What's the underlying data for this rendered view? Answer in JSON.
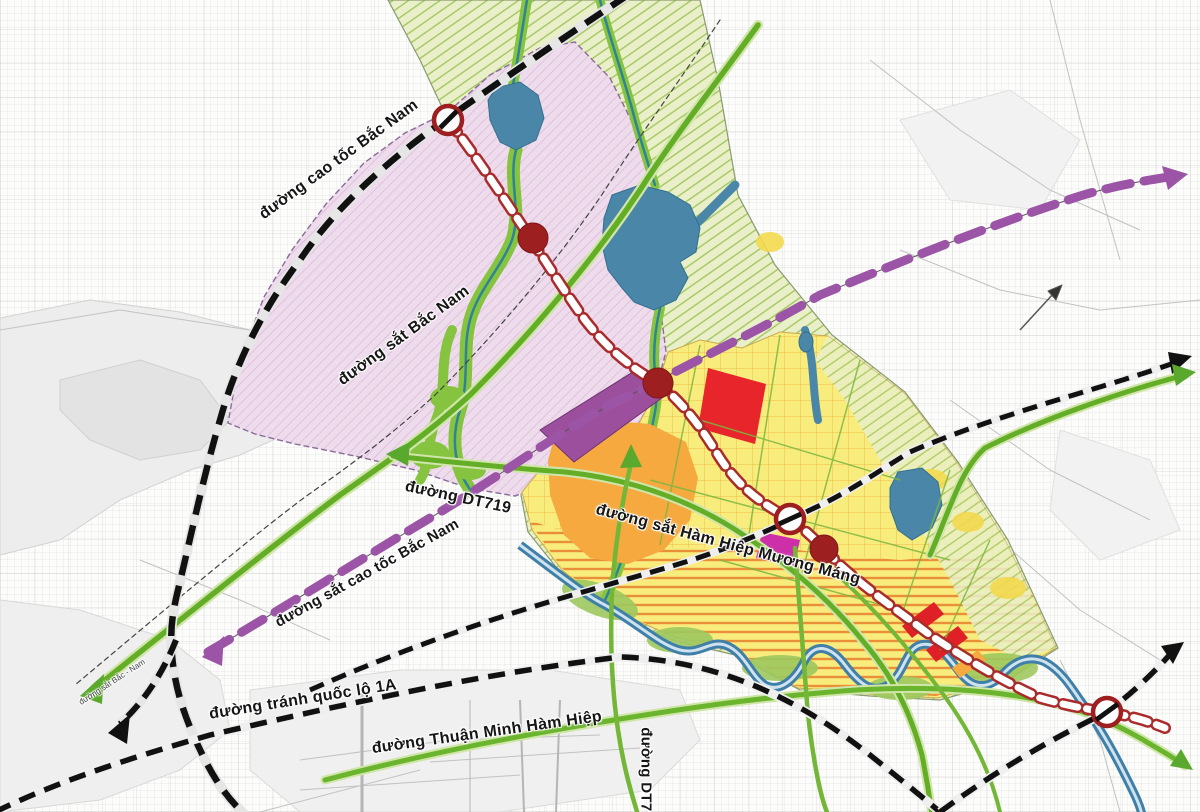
{
  "labels": {
    "expressway": "đường cao tốc Bắc Nam",
    "railway_north_south": "đường sắt Bắc Nam",
    "road_dt719": "đường DT719",
    "hsr": "đường sắt cao tốc Bắc Nam",
    "bypass_1a": "đường tránh quốc lộ 1A",
    "road_thuan_minh": "đường Thuận Minh Hàm Hiệp",
    "railway_ham_hiep": "đường sắt Hàm Hiệp Mương Máng",
    "road_dt718": "đường DT718",
    "railway_small": "đường sắt Bắc - Nam"
  },
  "colors": {
    "zone_pink": "#eedcec",
    "zone_green_hatch": "#e7efc6",
    "zone_green_stripe": "#a9c968",
    "zone_yellow": "#f8ec7d",
    "zone_orange": "#f5a93f",
    "zone_purple_block": "#9c4f9c",
    "zone_red_block": "#e8252a",
    "zone_magenta_block": "#cc2fa8",
    "water": "#4a86a8",
    "river_green_buffer": "#86c440",
    "road_green": "#63ad27",
    "road_black_dashed": "#111111",
    "hsr_purple": "#9c55a6",
    "railway_oval_red": "#aa2b2b",
    "station_dot": "#9e1f1f"
  }
}
